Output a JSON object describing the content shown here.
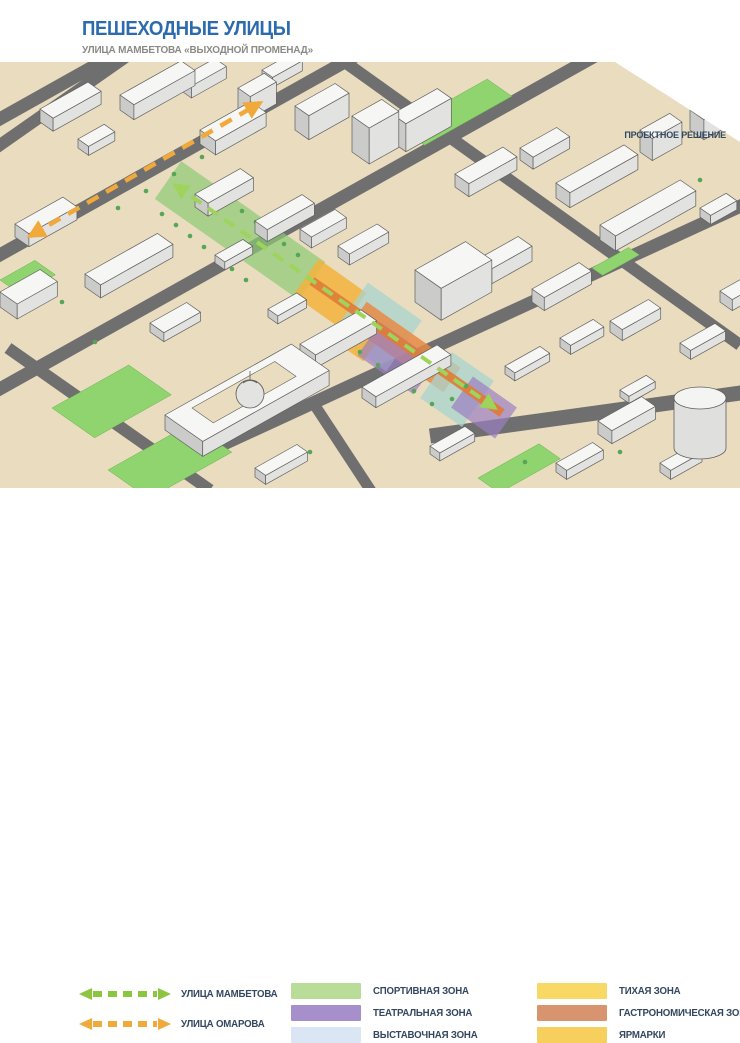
{
  "slide": {
    "title": "ПЕШЕХОДНЫЕ УЛИЦЫ",
    "subtitle": "УЛИЦА МАМБЕТОВА «ВЫХОДНОЙ ПРОМЕНАД»"
  },
  "map": {
    "corner_label": "ПРОЕКТНОЕ РЕШЕНИЕ",
    "background_color": "#E9DCBF",
    "street_color": "#6F6F6F",
    "park_color": "#8FD46F"
  },
  "legend": {
    "streets": [
      {
        "label": "УЛИЦА МАМБЕТОВА",
        "color": "#8CC63F"
      },
      {
        "label": "УЛИЦА ОМАРОВА",
        "color": "#F2A93B"
      }
    ],
    "zones": [
      {
        "label": "СПОРТИВНАЯ ЗОНА",
        "color": "#B9DD98"
      },
      {
        "label": "ТЕАТРАЛЬНАЯ ЗОНА",
        "color": "#A78FCB"
      },
      {
        "label": "ВЫСТАВОЧНАЯ ЗОНА",
        "color": "#DBE6F4"
      },
      {
        "label": "ТИХАЯ ЗОНА",
        "color": "#F8D966"
      },
      {
        "label": "ГАСТРОНОМИЧЕСКАЯ ЗОНА",
        "color": "#D8936F"
      },
      {
        "label": "ЯРМАРКИ",
        "color": "#F7CF5C"
      }
    ]
  }
}
